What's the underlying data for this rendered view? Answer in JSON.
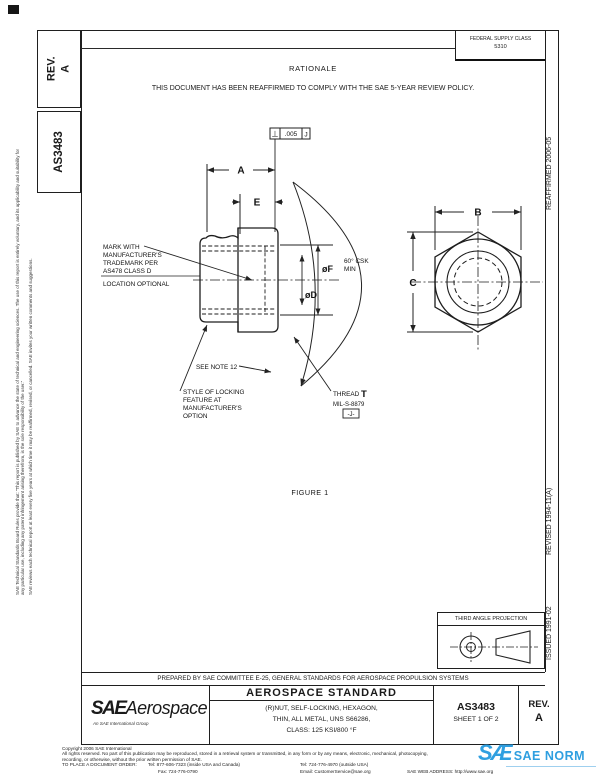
{
  "page": {
    "rev_sidebar": {
      "label": "REV.",
      "value": "A"
    },
    "doc_number_sidebar": "AS3483",
    "federal_supply": {
      "label": "FEDERAL SUPPLY CLASS",
      "value": "5310"
    },
    "rationale": {
      "title": "RATIONALE",
      "body": "THIS DOCUMENT HAS BEEN REAFFIRMED TO COMPLY WITH THE SAE 5-YEAR REVIEW POLICY."
    }
  },
  "left_margin": {
    "para1": "SAE Technical Standards Board Rules provide that: “This report is published by SAE to advance the state of technical and engineering sciences. The use of this report is entirely voluntary, and its applicability and suitability for any particular use, including any patent infringement arising therefrom, is the sole responsibility of the user.”",
    "para2": "SAE reviews each technical report at least every five years at which time it may be reaffirmed, revised, or cancelled. SAE invites your written comments and suggestions."
  },
  "right_margin": {
    "issued": "ISSUED 1991-02",
    "revised": "REVISED 1994-11(A)",
    "reaffirmed": "REAFFIRMED 2006-05"
  },
  "figure": {
    "fcf": {
      "symbol": "⊥",
      "tolerance": ".005",
      "datum": "J"
    },
    "dims": {
      "a": "A",
      "e": "E",
      "b": "B",
      "c": "C",
      "dia_f": "øF",
      "dia_d": "øD"
    },
    "csk_note_line1": "60° CSK",
    "csk_note_line2": "MIN",
    "mark_note_lines": [
      "MARK WITH",
      "MANUFACTURER'S",
      "TRADEMARK PER",
      "AS478 CLASS D",
      "LOCATION OPTIONAL"
    ],
    "see_note": "SEE NOTE 12",
    "locking_note_lines": [
      "STYLE OF LOCKING",
      "FEATURE AT",
      "MANUFACTURER'S",
      "OPTION"
    ],
    "thread": {
      "label": "THREAD",
      "letter": "T",
      "spec": "MIL-S-8879",
      "datum_flag": "-J-"
    },
    "caption": "FIGURE 1"
  },
  "projection_box": {
    "title": "THIRD ANGLE PROJECTION"
  },
  "title_block": {
    "prepared_by": "PREPARED BY SAE COMMITTEE E-25, GENERAL STANDARDS FOR AEROSPACE PROPULSION SYSTEMS",
    "logo": {
      "sae": "SAE",
      "aerospace": "Aerospace",
      "tagline": "An SAE International Group"
    },
    "standard_type": "AEROSPACE STANDARD",
    "title_lines": [
      "(R)NUT, SELF-LOCKING, HEXAGON,",
      "THIN, ALL METAL, UNS S66286,",
      "CLASS: 125 KSI/800 °F"
    ],
    "doc_number": "AS3483",
    "sheet": "SHEET 1 OF 2",
    "rev_label": "REV.",
    "rev_value": "A"
  },
  "copyright": {
    "line1": "Copyright 2006 SAE International",
    "line2": "All rights reserved. No part of this publication may be reproduced, stored in a retrieval system or transmitted, in any form or by any means, electronic, mechanical, photocopying,",
    "line3": "recording, or otherwise, without the prior written permission of SAE.",
    "order_label": "TO PLACE A DOCUMENT ORDER:",
    "tel_inside": "Tel: 877-606-7323 (inside USA and Canada)",
    "tel_outside": "Tel: 724-776-4970 (outside USA)",
    "fax": "Fax: 724-776-0790",
    "email": "Email: CustomerService@sae.org",
    "web": "SAE WEB ADDRESS: http://www.sae.org"
  },
  "watermark": {
    "logo": "SÆ",
    "text": "SAE NORM",
    "color": "#2f9fe0"
  }
}
